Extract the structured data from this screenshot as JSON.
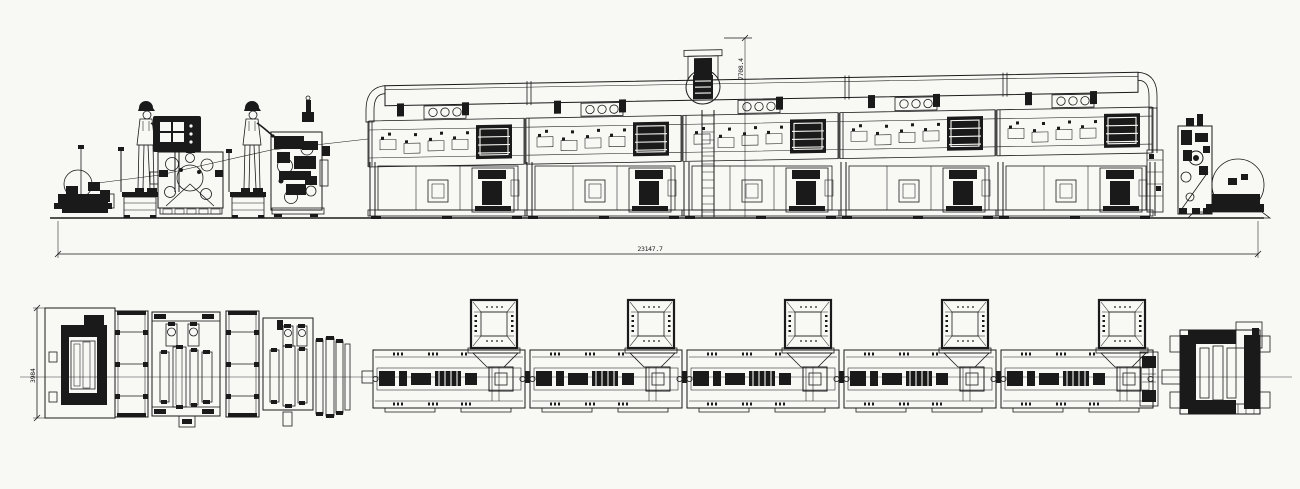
{
  "drawing": {
    "type": "CAD machine line drawing",
    "views": {
      "top": "side-elevation",
      "bottom": "plan-view"
    },
    "colors": {
      "background": "#f8f8f5",
      "line": "#1a1a1a"
    },
    "dimensions": {
      "overall_length_label": "23147.7",
      "machine_height_label": "7708.4",
      "machine_width_label": "3984"
    },
    "counts": {
      "oven_sections": 5,
      "exhaust_hoods": 5,
      "operators": 2,
      "vent_circles_per_section": 3
    }
  }
}
